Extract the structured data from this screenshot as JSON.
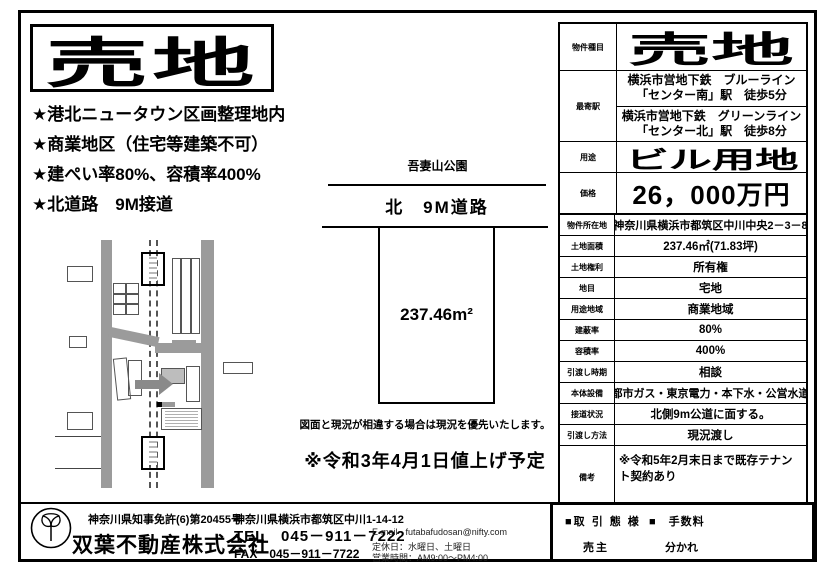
{
  "flyer": {
    "title": "売地",
    "highlights": [
      "★港北ニュータウン区画整理地内",
      "★商業地区（住宅等建築不可）",
      "★建ぺい率80%、容積率400%",
      "★北道路　9M接道"
    ],
    "diagram": {
      "park": "吾妻山公園",
      "road": "北　9M道路",
      "area": "237.46m²",
      "disclaimer": "図面と現況が相違する場合は現況を優先いたします。",
      "notice": "※令和3年4月1日値上げ予定"
    },
    "summary": {
      "type_label": "物件種目",
      "type_value": "売地",
      "station_label": "最寄駅",
      "station1_line1": "横浜市営地下鉄　ブルーライン",
      "station1_line2": "「センター南」駅　徒歩5分",
      "station2_line1": "横浜市営地下鉄　グリーンライン",
      "station2_line2": "「センター北」駅　徒歩8分",
      "use_label": "用途",
      "use_value": "ビル用地",
      "price_label": "価格",
      "price_value": "26，000万円"
    },
    "details": {
      "rows": [
        {
          "label": "物件所在地",
          "value": "神奈川県横浜市都筑区中川中央2－3－8"
        },
        {
          "label": "土地面積",
          "value": "237.46㎡(71.83坪)"
        },
        {
          "label": "土地権利",
          "value": "所有権"
        },
        {
          "label": "地目",
          "value": "宅地"
        },
        {
          "label": "用途地域",
          "value": "商業地域"
        },
        {
          "label": "建蔽率",
          "value": "80%"
        },
        {
          "label": "容積率",
          "value": "400%"
        },
        {
          "label": "引渡し時期",
          "value": "相談"
        },
        {
          "label": "本体設備",
          "value": "都市ガス・東京電力・本下水・公営水道"
        },
        {
          "label": "接道状況",
          "value": "北側9m公道に面する。"
        },
        {
          "label": "引渡し方法",
          "value": "現況渡し"
        },
        {
          "label": "備考",
          "value": "※令和5年2月末日まで既存テナント契約あり"
        }
      ]
    },
    "footer": {
      "license": "神奈川県知事免許(6)第20455号",
      "company": "双葉不動産株式会社",
      "address": "神奈川県横浜市都筑区中川1-14-12",
      "tel": "TEL　045－911－7222",
      "fax": "FAX　045－911－7722",
      "email_label": "E-mail",
      "email": "futabafudosan@nifty.com",
      "closed_days": "定休日：水曜日、土曜日",
      "hours": "営業時間：AM9:00～PM4:00",
      "deal_label": "■取 引 態 様",
      "deal_value": "売主",
      "fee_label": "■　手数料",
      "fee_value": "分かれ"
    }
  }
}
